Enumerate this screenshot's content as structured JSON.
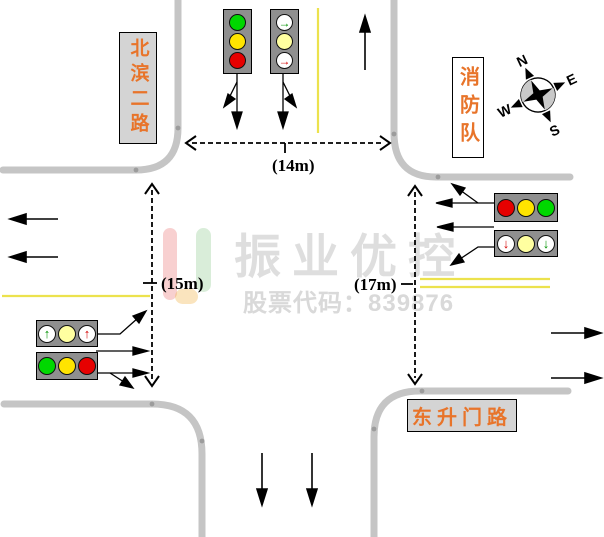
{
  "signs": {
    "north_road": {
      "text": "北滨二路"
    },
    "fire_station": {
      "text": "消防队"
    },
    "east_road": {
      "text": "东升门路"
    }
  },
  "measurements": {
    "north_approach": "(14m)",
    "west_approach": "(15m)",
    "east_approach": "(17m)"
  },
  "compass": {
    "n": "N",
    "e": "E",
    "s": "S",
    "w": "W"
  },
  "watermark": {
    "brand": "振业优控",
    "stock_label": "股票代码：839876"
  },
  "glyphs": {
    "arrow-up": "↑",
    "arrow-right": "→",
    "arrow-down": "↓"
  },
  "colors": {
    "road": "#c5c5c5",
    "junction_dot": "#9c9c9c",
    "lane_yellow": "#ece24d",
    "sign_text": "#e8742a",
    "lamp_green": "#00d800",
    "lamp_yellow": "#ffe400",
    "lamp_red": "#e60000",
    "lamp_pale": "#ffffa0",
    "watermark_gray": "#dedede"
  },
  "lights": {
    "north_straight": {
      "orientation": "vertical",
      "lamps": [
        {
          "shape": "circle",
          "color": "green"
        },
        {
          "shape": "circle",
          "color": "yellow"
        },
        {
          "shape": "circle",
          "color": "red"
        }
      ]
    },
    "north_turn": {
      "orientation": "vertical",
      "lamps": [
        {
          "shape": "arrow-right",
          "color": "green"
        },
        {
          "shape": "pale",
          "color": "yellow"
        },
        {
          "shape": "arrow-right",
          "color": "red"
        }
      ]
    },
    "east_straight": {
      "orientation": "horizontal",
      "lamps": [
        {
          "shape": "circle",
          "color": "red"
        },
        {
          "shape": "circle",
          "color": "yellow"
        },
        {
          "shape": "circle",
          "color": "green"
        }
      ]
    },
    "east_turn": {
      "orientation": "horizontal",
      "lamps": [
        {
          "shape": "arrow-down",
          "color": "red"
        },
        {
          "shape": "pale",
          "color": "yellow"
        },
        {
          "shape": "arrow-down",
          "color": "green"
        }
      ]
    },
    "west_turn": {
      "orientation": "horizontal",
      "lamps": [
        {
          "shape": "arrow-up",
          "color": "green"
        },
        {
          "shape": "pale",
          "color": "yellow"
        },
        {
          "shape": "arrow-up",
          "color": "red"
        }
      ]
    },
    "west_straight": {
      "orientation": "horizontal",
      "lamps": [
        {
          "shape": "circle",
          "color": "green"
        },
        {
          "shape": "circle",
          "color": "yellow"
        },
        {
          "shape": "circle",
          "color": "red"
        }
      ]
    }
  }
}
